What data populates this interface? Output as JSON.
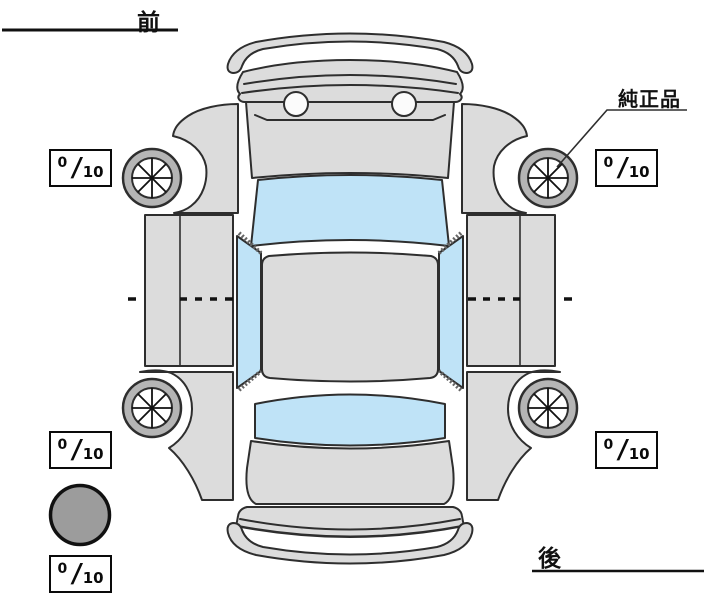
{
  "diagram": {
    "type": "vehicle-condition-top-view",
    "orientation": {
      "front_label": "前",
      "rear_label": "後"
    },
    "annotation": {
      "genuine_part_label": "純正品",
      "genuine_part_points_to": "front-right-wheel"
    },
    "tread_depth_boxes": [
      {
        "position": "front-left",
        "numerator": "0",
        "slash": "/",
        "denominator": "10"
      },
      {
        "position": "front-right",
        "numerator": "0",
        "slash": "/",
        "denominator": "10"
      },
      {
        "position": "rear-left",
        "numerator": "0",
        "slash": "/",
        "denominator": "10"
      },
      {
        "position": "rear-right",
        "numerator": "0",
        "slash": "/",
        "denominator": "10"
      },
      {
        "position": "spare",
        "numerator": "0",
        "slash": "/",
        "denominator": "10"
      }
    ]
  },
  "colors": {
    "body": "#dcdcdc",
    "glass": "#bfe3f7",
    "tire": "#b5b5b5",
    "rim": "#ffffff",
    "spare": "#9c9c9c",
    "headlight": "#fbfbfb",
    "outline": "#2e2e2e",
    "line": "#111111",
    "hatch": "#666666"
  }
}
